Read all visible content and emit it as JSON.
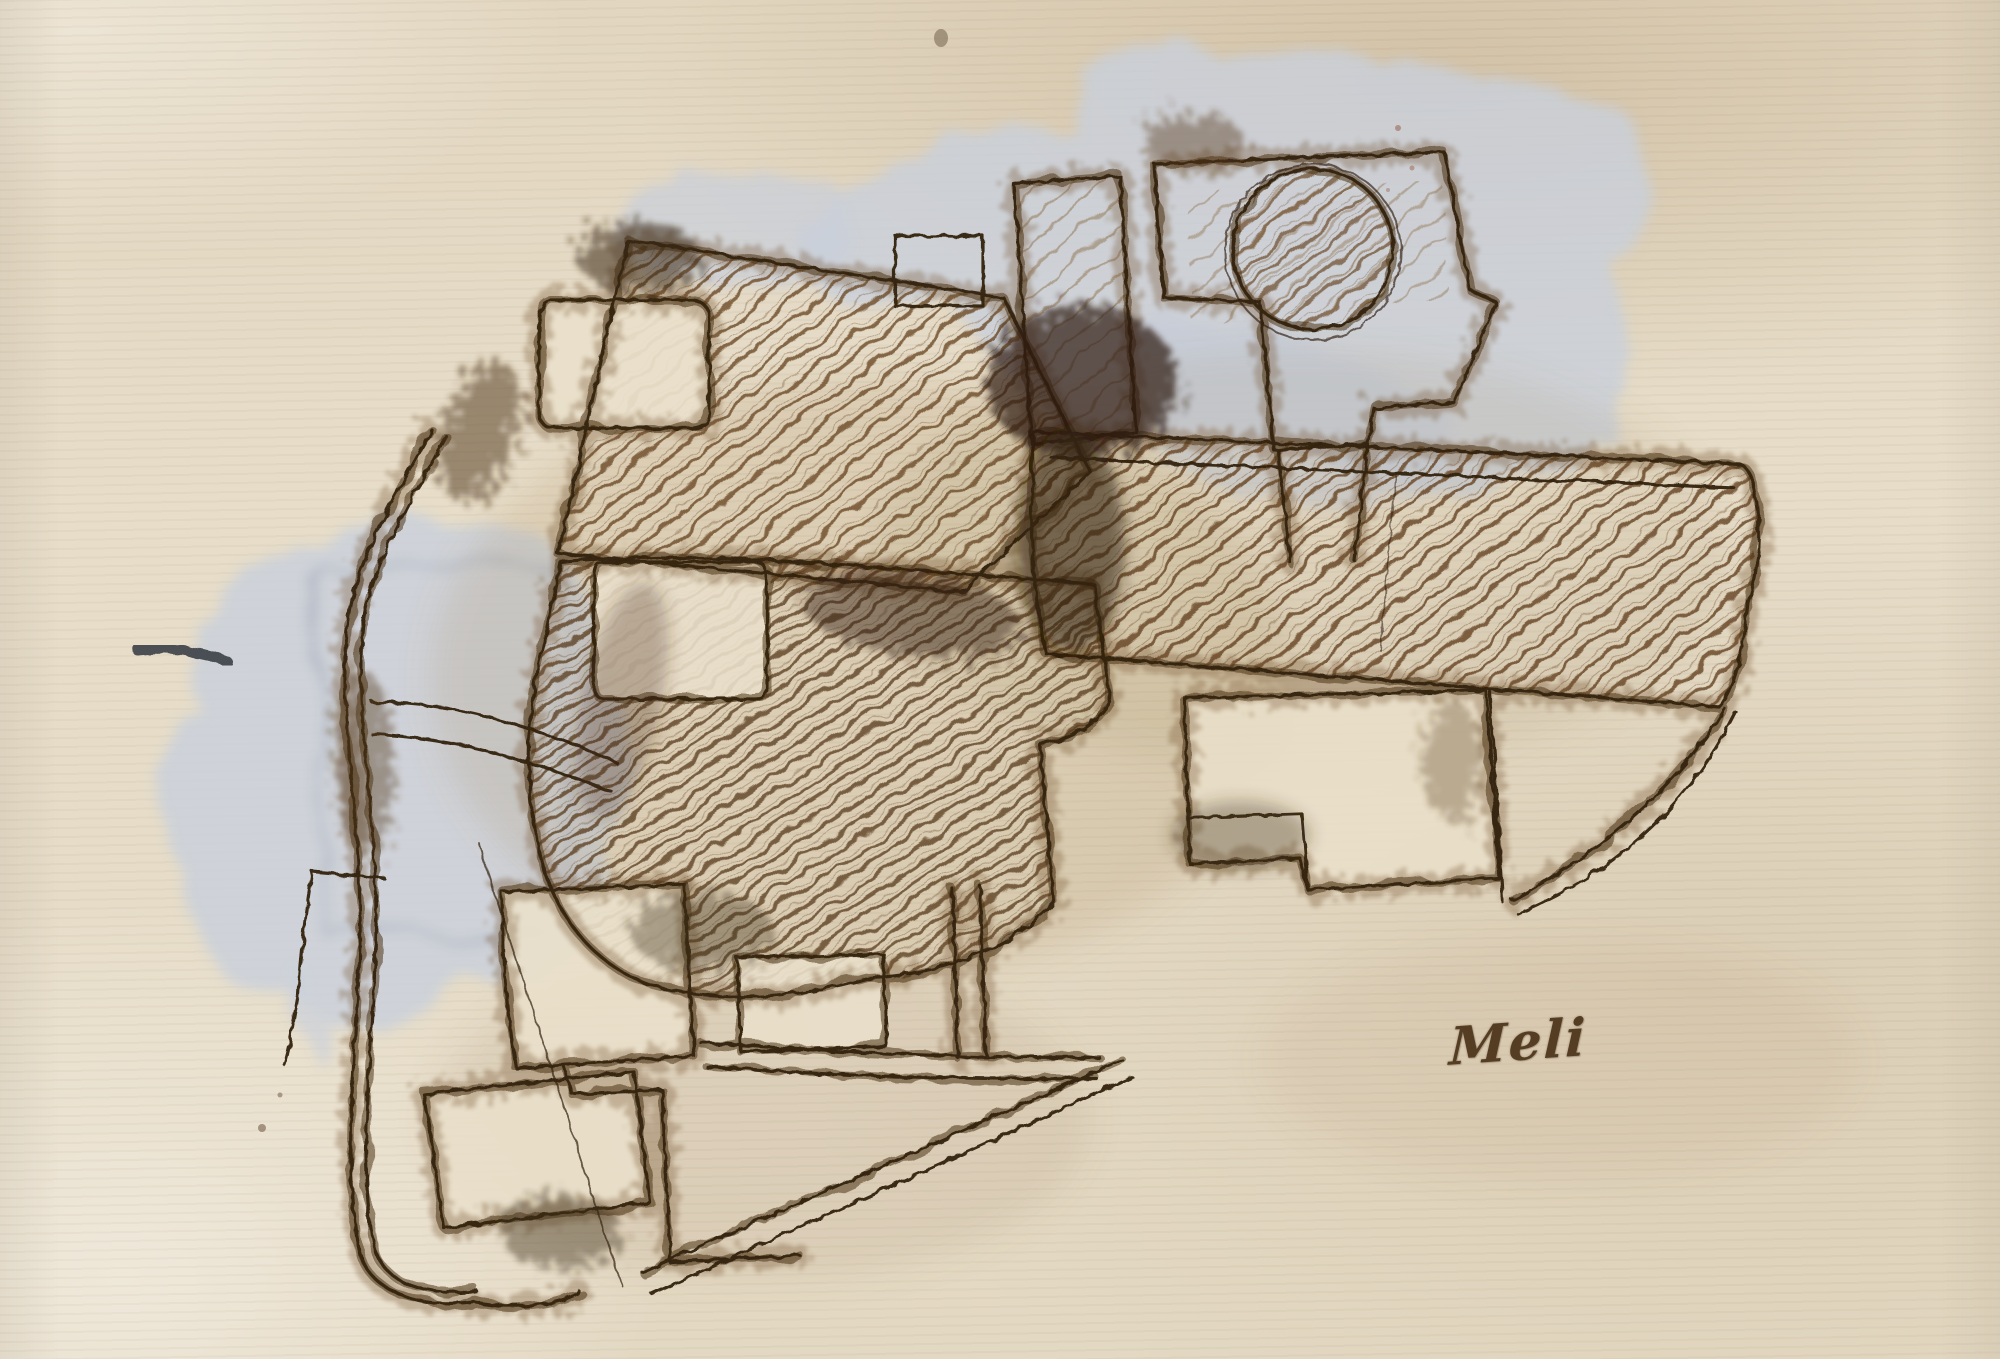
{
  "artwork": {
    "signature": "Meli",
    "palette": {
      "paper_cream": "#e7ddc9",
      "paper_shadow_tan": "#d2c3a6",
      "ink_sepia_darkest": "#30200f",
      "ink_sepia_mid": "#4d3419",
      "ink_sepia_halo": "#6e4b28",
      "wash_blue_gray": "#c9cfda",
      "wash_outline_gray": "#a9b1bf",
      "wash_slate_dash": "#3b4046"
    }
  }
}
